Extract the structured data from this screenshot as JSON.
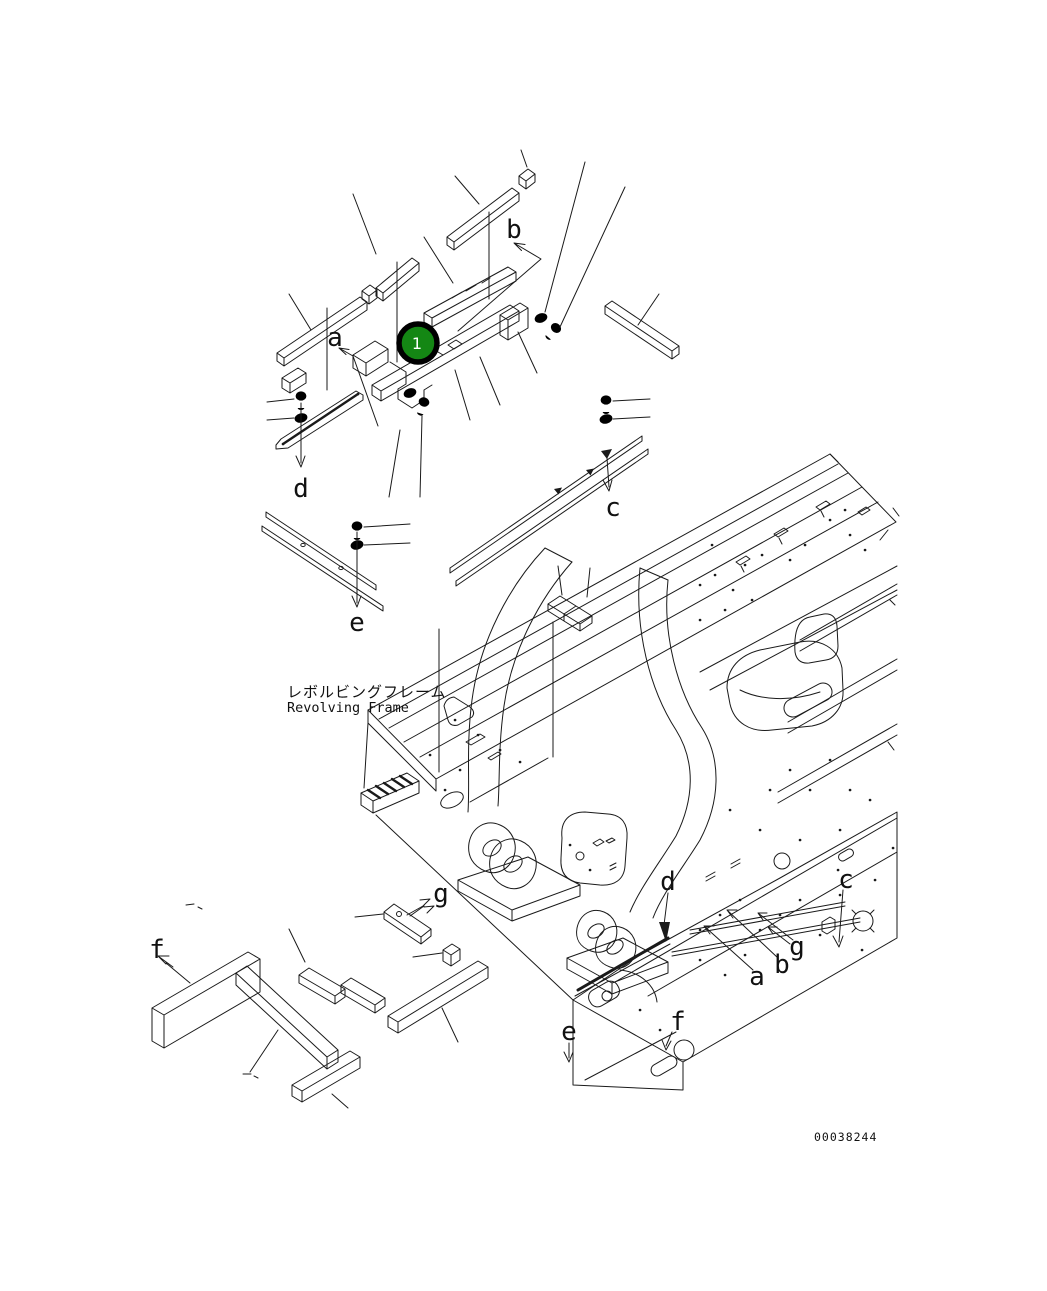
{
  "figure": {
    "frame_label_jp": "レボルビングフレーム",
    "frame_label_en": "Revolving Frame",
    "drawing_number": "00038244"
  },
  "badge": {
    "number": "1",
    "fill": "#148714"
  },
  "callouts": {
    "top_a": "a",
    "top_b": "b",
    "top_c": "c",
    "top_d": "d",
    "top_e": "e",
    "bottom_f": "f",
    "bottom_g": "g",
    "frame_d": "d",
    "frame_c": "c",
    "frame_g": "g",
    "frame_b": "b",
    "frame_a": "a",
    "frame_e": "e",
    "frame_f": "f"
  },
  "colors": {
    "ink": "#1a1a1a",
    "background": "#ffffff",
    "badge_green": "#148714",
    "badge_text": "#ffffff"
  }
}
